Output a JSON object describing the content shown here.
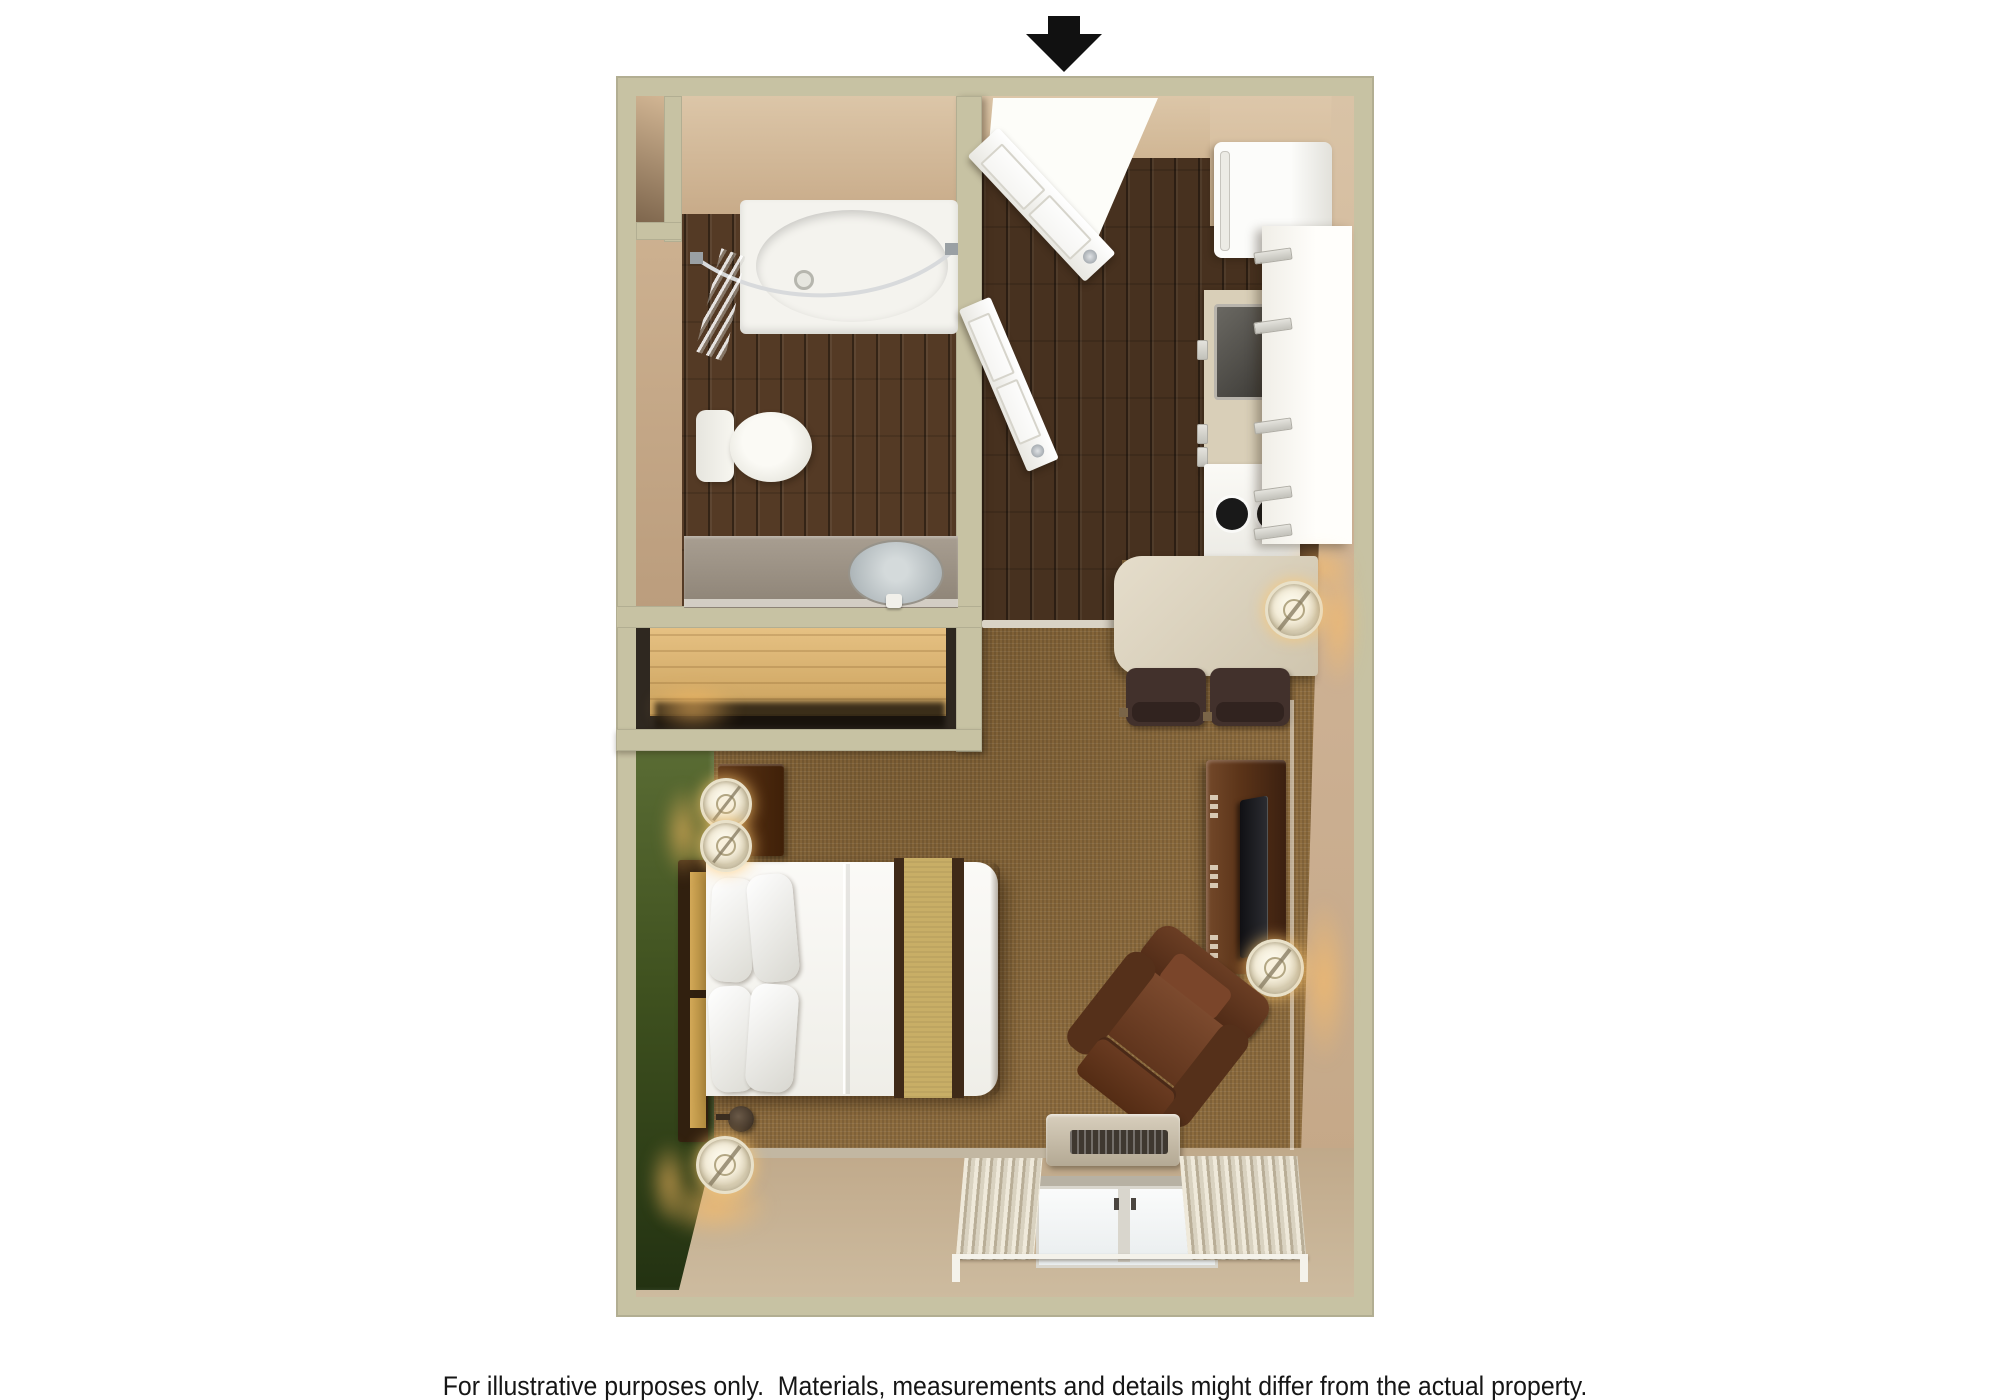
{
  "page": {
    "background_color": "#ffffff"
  },
  "entrance_indicator": {
    "icon": "arrow-down-icon",
    "color": "#111111"
  },
  "caption": {
    "text": "For illustrative purposes only.  Materials, measurements and details might differ from the actual property."
  },
  "floor_plan": {
    "type": "studio-suite-3d-top-view",
    "rooms": [
      {
        "name": "bathroom",
        "floor": "dark-wood",
        "fixtures": [
          "bathtub",
          "shower-curtain-rod",
          "shower-curtain",
          "toilet",
          "vanity-counter",
          "sink"
        ]
      },
      {
        "name": "closet",
        "fixtures": [
          "wood-shelf"
        ]
      },
      {
        "name": "entry",
        "floor": "dark-wood",
        "fixtures": [
          "entry-door-open",
          "bathroom-door-open"
        ]
      },
      {
        "name": "kitchen",
        "fixtures": [
          "refrigerator",
          "upper-cabinets",
          "counter",
          "kitchen-sink",
          "stove-two-burners"
        ]
      },
      {
        "name": "dining",
        "fixtures": [
          "table",
          "dining-chair",
          "dining-chair",
          "table-lamp"
        ]
      },
      {
        "name": "living",
        "floor": "carpet",
        "fixtures": [
          "tv-dresser",
          "flat-tv",
          "armchair-recliner",
          "ac-heater-unit",
          "window-two-panes",
          "curtains",
          "curtain-rod",
          "floor-lamp"
        ]
      },
      {
        "name": "bedroom",
        "floor": "carpet",
        "accent_wall": "green",
        "fixtures": [
          "queen-bed",
          "headboard",
          "pillows-4",
          "gold-bed-runner",
          "nightstand",
          "nightstand-lamp",
          "nightstand-lamp",
          "wall-sconce",
          "floor-lamp"
        ]
      }
    ],
    "palette": {
      "outer_wall": "#c7c2a3",
      "interior_wall_face": "#d3bb9c",
      "bottom_wall_face": "#c6b093",
      "green_accent_wall": "#3f511f",
      "wood_floor": "#47311f",
      "carpet": "#8d6c3e",
      "fixture_white": "#f4f3ee",
      "vanity_gray": "#a0968a",
      "sink_blue_gray": "#bcc3c6",
      "closet_shelf_wood": "#ddb878",
      "table_beige": "#d8cfbc",
      "chair_brown": "#42312c",
      "dresser_walnut": "#5a3318",
      "tv_black": "#1f2024",
      "armchair_brown": "#6b3f28",
      "bed_runner_gold": "#c8ae66",
      "bed_trim_brown": "#3f2a18",
      "lamp_glow": "#ffbe64",
      "arrow_black": "#111111"
    }
  }
}
